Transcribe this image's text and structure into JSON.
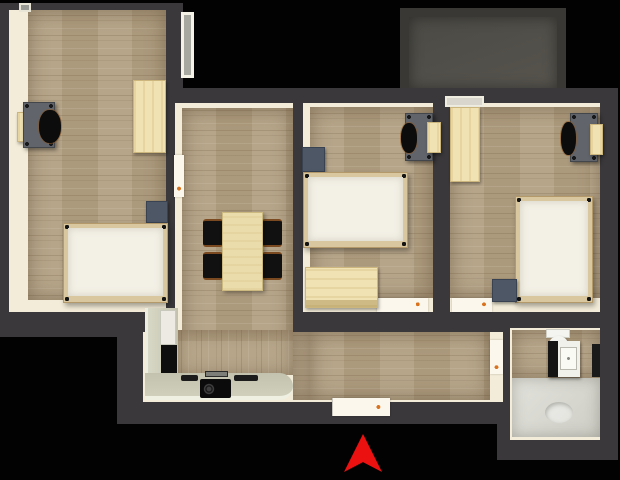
{
  "scene": {
    "type": "3d-floorplan-top-down-render",
    "background_color": "#000000",
    "marker": {
      "name": "entrance-arrow",
      "shape": "upward-arrowhead",
      "color": "#ec1111"
    }
  },
  "palette": {
    "wall": "#3a383a",
    "wall_inner_face": "#f3ecd8",
    "wood_floor": "#b2a083",
    "kitchen_counter": "#c6c6b2",
    "bathroom_tile": "#d9d9d1",
    "light_wood_furniture": "#f0e2b2",
    "slate_furniture": "#4d5766",
    "desk_gray": "#61656b",
    "mattress_white": "#f3f0e6",
    "balcony_floor": "#52504a",
    "door_handle_accent": "#d9731f"
  },
  "rooms": [
    {
      "id": "bedroom-left",
      "furniture": [
        "double-bed",
        "nightstand",
        "wardrobe",
        "desk",
        "chair",
        "wall-shelf"
      ]
    },
    {
      "id": "living-dining",
      "furniture": [
        "dining-table",
        "four-chairs",
        "l-shaped-kitchen-counter",
        "cooktop",
        "tall-black-appliance",
        "white-appliance"
      ]
    },
    {
      "id": "bedroom-middle",
      "furniture": [
        "double-bed",
        "nightstand",
        "dresser",
        "desk",
        "chair",
        "wall-shelf"
      ]
    },
    {
      "id": "bedroom-right",
      "furniture": [
        "double-bed",
        "nightstand",
        "wardrobe",
        "desk",
        "chair",
        "wall-shelf"
      ]
    },
    {
      "id": "bathroom",
      "furniture": [
        "toilet",
        "vanity-sink",
        "mirror",
        "shower-area-with-drain"
      ]
    },
    {
      "id": "hallway",
      "furniture": []
    },
    {
      "id": "balcony",
      "furniture": []
    }
  ]
}
